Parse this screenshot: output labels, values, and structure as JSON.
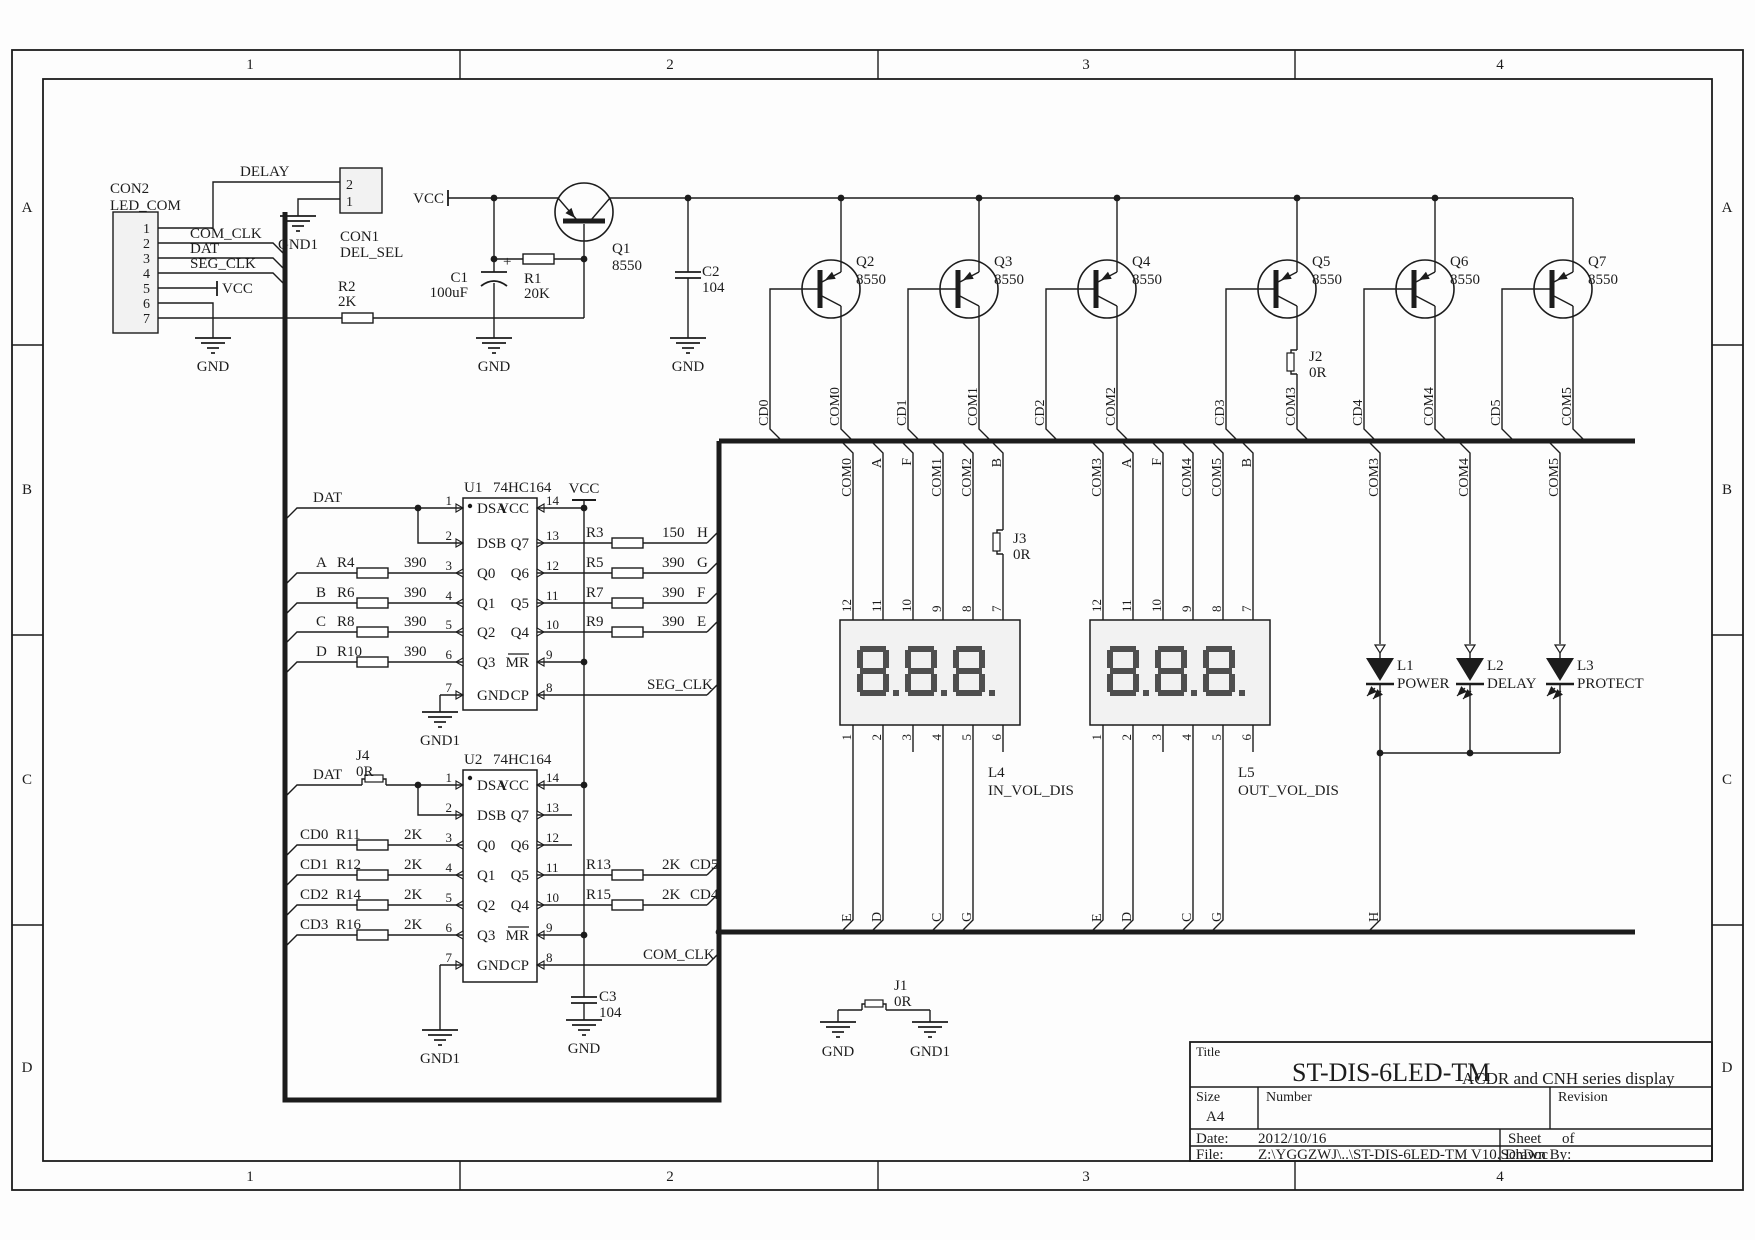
{
  "sheet": {
    "columns": [
      "1",
      "2",
      "3",
      "4"
    ],
    "rows": [
      "A",
      "B",
      "C",
      "D"
    ]
  },
  "title_block": {
    "title_label": "Title",
    "title": "ST-DIS-6LED-TM",
    "subtitle": "ACDR and CNH series display",
    "size_label": "Size",
    "size": "A4",
    "number_label": "Number",
    "revision_label": "Revision",
    "date_label": "Date:",
    "date": "2012/10/16",
    "sheet_label": "Sheet",
    "sheet_of_label": "of",
    "file_label": "File:",
    "file": "Z:\\YGGZWJ\\..\\ST-DIS-6LED-TM V10.SchDoc",
    "drawn_label": "Drawn By:"
  },
  "nets": {
    "delay": "DELAY",
    "com_clk": "COM_CLK",
    "dat": "DAT",
    "seg_clk": "SEG_CLK",
    "vcc": "VCC",
    "gnd": "GND",
    "gnd1": "GND1",
    "h": "H"
  },
  "con2": {
    "ref": "CON2",
    "name": "LED_COM",
    "pins": [
      "1",
      "2",
      "3",
      "4",
      "5",
      "6",
      "7"
    ]
  },
  "con1": {
    "ref": "CON1",
    "name": "DEL_SEL",
    "pin_top": "2",
    "pin_bottom": "1"
  },
  "q1": {
    "ref": "Q1",
    "value": "8550"
  },
  "r1": {
    "ref": "R1",
    "value": "20K"
  },
  "r2": {
    "ref": "R2",
    "value": "2K"
  },
  "c1": {
    "ref": "C1",
    "value": "100uF",
    "polarity": "+"
  },
  "c2": {
    "ref": "C2",
    "value": "104"
  },
  "c3": {
    "ref": "C3",
    "value": "104"
  },
  "j1": {
    "ref": "J1",
    "value": "0R"
  },
  "j2": {
    "ref": "J2",
    "value": "0R"
  },
  "j3": {
    "ref": "J3",
    "value": "0R"
  },
  "j4": {
    "ref": "J4",
    "value": "0R"
  },
  "drivers": [
    {
      "ref": "Q2",
      "value": "8550",
      "cd": "CD0",
      "com": "COM0"
    },
    {
      "ref": "Q3",
      "value": "8550",
      "cd": "CD1",
      "com": "COM1"
    },
    {
      "ref": "Q4",
      "value": "8550",
      "cd": "CD2",
      "com": "COM2"
    },
    {
      "ref": "Q5",
      "value": "8550",
      "cd": "CD3",
      "com": "COM3"
    },
    {
      "ref": "Q6",
      "value": "8550",
      "cd": "CD4",
      "com": "COM4"
    },
    {
      "ref": "Q7",
      "value": "8550",
      "cd": "CD5",
      "com": "COM5"
    }
  ],
  "u1": {
    "ref": "U1",
    "part": "74HC164",
    "left_pins": [
      {
        "n": "1",
        "name": "DSA"
      },
      {
        "n": "2",
        "name": "DSB"
      },
      {
        "n": "3",
        "name": "Q0"
      },
      {
        "n": "4",
        "name": "Q1"
      },
      {
        "n": "5",
        "name": "Q2"
      },
      {
        "n": "6",
        "name": "Q3"
      },
      {
        "n": "7",
        "name": "GND"
      }
    ],
    "right_pins": [
      {
        "n": "14",
        "name": "VCC"
      },
      {
        "n": "13",
        "name": "Q7"
      },
      {
        "n": "12",
        "name": "Q6"
      },
      {
        "n": "11",
        "name": "Q5"
      },
      {
        "n": "10",
        "name": "Q4"
      },
      {
        "n": "9",
        "name": "MR"
      },
      {
        "n": "8",
        "name": "CP"
      }
    ],
    "inputs": [
      {
        "net": "A",
        "res": "R4",
        "val": "390"
      },
      {
        "net": "B",
        "res": "R6",
        "val": "390"
      },
      {
        "net": "C",
        "res": "R8",
        "val": "390"
      },
      {
        "net": "D",
        "res": "R10",
        "val": "390"
      }
    ],
    "outputs": [
      {
        "res": "R3",
        "val": "150",
        "net": "H"
      },
      {
        "res": "R5",
        "val": "390",
        "net": "G"
      },
      {
        "res": "R7",
        "val": "390",
        "net": "F"
      },
      {
        "res": "R9",
        "val": "390",
        "net": "E"
      }
    ]
  },
  "u2": {
    "ref": "U2",
    "part": "74HC164",
    "left_pins": [
      {
        "n": "1",
        "name": "DSA"
      },
      {
        "n": "2",
        "name": "DSB"
      },
      {
        "n": "3",
        "name": "Q0"
      },
      {
        "n": "4",
        "name": "Q1"
      },
      {
        "n": "5",
        "name": "Q2"
      },
      {
        "n": "6",
        "name": "Q3"
      },
      {
        "n": "7",
        "name": "GND"
      }
    ],
    "right_pins": [
      {
        "n": "14",
        "name": "VCC"
      },
      {
        "n": "13",
        "name": "Q7"
      },
      {
        "n": "12",
        "name": "Q6"
      },
      {
        "n": "11",
        "name": "Q5"
      },
      {
        "n": "10",
        "name": "Q4"
      },
      {
        "n": "9",
        "name": "MR"
      },
      {
        "n": "8",
        "name": "CP"
      }
    ],
    "inputs": [
      {
        "net": "CD0",
        "res": "R11",
        "val": "2K"
      },
      {
        "net": "CD1",
        "res": "R12",
        "val": "2K"
      },
      {
        "net": "CD2",
        "res": "R14",
        "val": "2K"
      },
      {
        "net": "CD3",
        "res": "R16",
        "val": "2K"
      }
    ],
    "outputs": [
      {
        "res": "R13",
        "val": "2K",
        "net": "CD5"
      },
      {
        "res": "R15",
        "val": "2K",
        "net": "CD4"
      }
    ]
  },
  "displays": [
    {
      "ref": "L4",
      "name": "IN_VOL_DIS",
      "top_nets": [
        "COM0",
        "A",
        "F",
        "COM1",
        "COM2",
        "B"
      ],
      "top_pin_numbers": [
        "12",
        "11",
        "10",
        "9",
        "8",
        "7"
      ],
      "top_pin_names": [
        "C0",
        "A",
        "F",
        "C1",
        "C2",
        "B"
      ],
      "bottom_pin_names": [
        "E",
        "D",
        "DP",
        "C",
        "G",
        "NC"
      ],
      "bottom_pin_numbers": [
        "1",
        "2",
        "3",
        "4",
        "5",
        "6"
      ],
      "bottom_nets": [
        "E",
        "D",
        "",
        "C",
        "G",
        ""
      ]
    },
    {
      "ref": "L5",
      "name": "OUT_VOL_DIS",
      "top_nets": [
        "COM3",
        "A",
        "F",
        "COM4",
        "COM5",
        "B"
      ],
      "top_pin_numbers": [
        "12",
        "11",
        "10",
        "9",
        "8",
        "7"
      ],
      "top_pin_names": [
        "C0",
        "A",
        "F",
        "C1",
        "C2",
        "B"
      ],
      "bottom_pin_names": [
        "E",
        "D",
        "DP",
        "C",
        "G",
        "NC"
      ],
      "bottom_pin_numbers": [
        "1",
        "2",
        "3",
        "4",
        "5",
        "6"
      ],
      "bottom_nets": [
        "E",
        "D",
        "",
        "C",
        "G",
        ""
      ]
    }
  ],
  "leds": [
    {
      "ref": "L1",
      "name": "POWER",
      "net": "COM3"
    },
    {
      "ref": "L2",
      "name": "DELAY",
      "net": "COM4"
    },
    {
      "ref": "L3",
      "name": "PROTECT",
      "net": "COM5"
    }
  ]
}
